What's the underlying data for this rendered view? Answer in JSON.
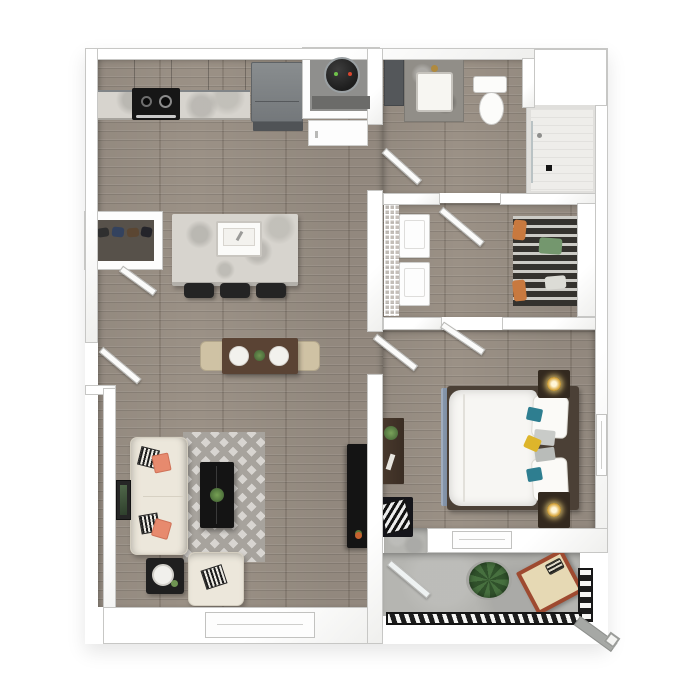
{
  "canvas": {
    "width_px": 697,
    "height_px": 697,
    "background": "#ffffff"
  },
  "floorplan": {
    "kind": "3d-top-down-apartment-floor-plan",
    "visible_text": [],
    "rooms": [
      {
        "id": "kitchen",
        "label": "Kitchen",
        "furniture": [
          "upper cabinets",
          "marble countertop",
          "stove with burners",
          "refrigerator",
          "kitchen island with sink",
          "three bar stools"
        ]
      },
      {
        "id": "living-dining",
        "label": "Living / Dining Room",
        "furniture": [
          "dining table with two plates and centerpiece",
          "two dining chairs",
          "cream sofa with coral and striped pillows",
          "chevron area rug",
          "black coffee table with plant",
          "black side table",
          "cream armchair",
          "tv console",
          "framed wall art",
          "window"
        ]
      },
      {
        "id": "entry",
        "label": "Entry",
        "furniture": [
          "entry door",
          "coat closet with shoes"
        ]
      },
      {
        "id": "utility",
        "label": "Water Heater Closet",
        "furniture": [
          "water heater",
          "hall cabinet"
        ]
      },
      {
        "id": "bathroom",
        "label": "Bathroom",
        "furniture": [
          "vanity with sink",
          "toilet",
          "walk-in shower",
          "linen cabinet"
        ]
      },
      {
        "id": "walk-in-closet",
        "label": "Walk-in Closet / Laundry",
        "furniture": [
          "washer",
          "dryer",
          "wire shelving",
          "hanging clothes"
        ]
      },
      {
        "id": "bedroom",
        "label": "Bedroom",
        "furniture": [
          "bed with teal, gray and yellow pillows",
          "two nightstands with lamps",
          "blue area rug",
          "desk with plant",
          "bench with chevron pillow",
          "two windows"
        ]
      },
      {
        "id": "balcony",
        "label": "Balcony",
        "furniture": [
          "round rug",
          "potted plant",
          "rust lounge chair with tan cushion",
          "metal railing"
        ]
      }
    ],
    "colors": {
      "page_bg": "#ffffff",
      "wall_fill": "#ffffff",
      "wall_line": "#c7c7c5",
      "wood_floor": "#9b9186",
      "concrete": "#b5b5b1",
      "marble": "#d7d4ce",
      "cabinet_gray": "#a4a8aa",
      "appliance_dark": "#74787b",
      "stove_black": "#161616",
      "table_wood": "#5a4334",
      "chair_beige": "#cfc2a4",
      "sofa_cream": "#ece7db",
      "pillow_coral": "#e78a6e",
      "rug_light": "#d8d5d1",
      "rug_accent": "#a7a39d",
      "tv_black": "#141414",
      "bed_frame": "#4b4036",
      "pillow_teal": "#2e7e90",
      "pillow_yellow": "#ddb52b",
      "nightstand_dark": "#33291f",
      "lamp_gold": "#d9aa45",
      "rug_blue": "#8595aa",
      "closet_dark": "#34322e",
      "clothes_orange": "#c8793f",
      "clothes_green": "#74976e",
      "railing_black": "#1c1c1c",
      "plant_green": "#47703f",
      "lounge_rust": "#9e4a30",
      "cushion_tan": "#e6d9b4",
      "door_white": "#fbfbfa",
      "shower_tile": "#eeedea",
      "water_heater": "#1d1d1d"
    }
  }
}
